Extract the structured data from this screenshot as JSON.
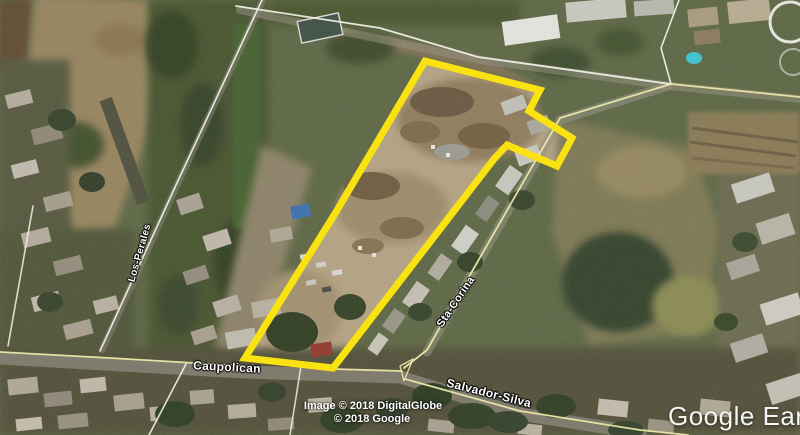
{
  "map": {
    "watermark": "Google Earth",
    "attribution": {
      "line1": "Image © 2018 DigitalGlobe",
      "line2": "© 2018 Google"
    },
    "street_labels": [
      {
        "id": "los-perales",
        "text": "Los-Perales"
      },
      {
        "id": "caupolican",
        "text": "Caupolican"
      },
      {
        "id": "sta-corina",
        "text": "Sta-Corina"
      },
      {
        "id": "salvador-silva",
        "text": "Salvador-Silva"
      }
    ],
    "parcel_outline": {
      "color": "#ffe606"
    },
    "road_colors": {
      "named_road": "#efeaa8",
      "minor_road": "#f7f7f0"
    }
  }
}
